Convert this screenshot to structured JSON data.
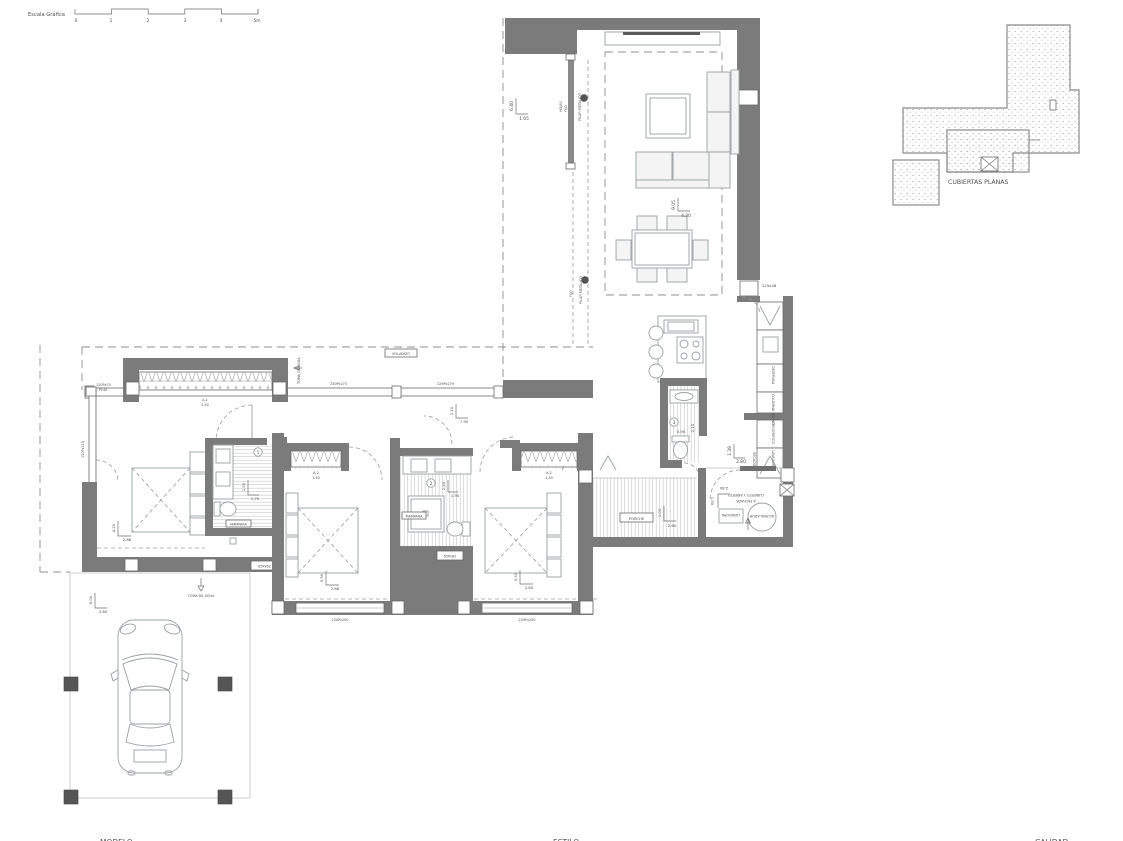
{
  "colors": {
    "background": "#ffffff",
    "wall": "#7b7b7b",
    "pillar_dark": "#555555",
    "line_light": "#9aa0a2",
    "hatch": "#cccccc",
    "dashed": "#8f8f8f",
    "text": "#4f4f4f",
    "stipple": "#a8a8a8"
  },
  "scale_bar": {
    "label": "Escala Gráfica",
    "ticks": [
      "0",
      "1",
      "2",
      "3",
      "4",
      "5m"
    ]
  },
  "roof_plan": {
    "label": "CUBIERTAS PLANAS"
  },
  "living_room": {
    "dim_v": "6.40",
    "dim_h": "1.65",
    "pilar1": "PILAR METÁLICO",
    "pilar2": "PILAR METÁLICO",
    "glass_l1": "HOJAS",
    "glass_l2": "FIJO",
    "glass2": "FIJO"
  },
  "dining": {
    "dim_v": "9.05",
    "dim_h": "4.30"
  },
  "front": {
    "voladizo": "VOLADIZO",
    "window1": "230Px275",
    "window2": "229Px279",
    "toma_agua": "TOMA DE AGUA",
    "hall_dim_v": "1.10",
    "hall_dim_h": "7.90"
  },
  "master_bedroom": {
    "window_code": "A-1",
    "window_size": "2.40",
    "side_l1": "120Px70",
    "side_l2": "PL40",
    "glass_label": "130Px115",
    "dim_v": "4.20",
    "dim_h": "2.88",
    "small_window": "65Px62"
  },
  "bathroom1": {
    "number": "1",
    "dim_v": "1.50",
    "dim_h": "1.70",
    "box_label": "MAMPARA"
  },
  "bedroom2": {
    "window_code": "A-2",
    "window_size": "1.40",
    "dim_v": "3.50",
    "dim_h": "2.88",
    "bottom_window": "230Px200"
  },
  "bathroom2": {
    "number": "2",
    "dim_v": "2.40",
    "dim_h": "1.90",
    "box_label": "MAMPARA",
    "small_window": "65Px62"
  },
  "bedroom3": {
    "window_code": "A-2",
    "window_size": "1.40",
    "dim_v": "3.50",
    "dim_h": "2.80",
    "bottom_window": "230Px200"
  },
  "wc3": {
    "number": "3",
    "dim_v": "2.15",
    "dim_h": "0.90"
  },
  "kitchen": {
    "entry_label": "125x48",
    "dim_v": "1.38",
    "dim_h": "2.80",
    "cabinets": [
      "DESPENSA",
      "COLUMNA HORNO",
      "FRIGORIFICO",
      "LAVADORA",
      "SECADORA"
    ]
  },
  "porch": {
    "label": "PORCHE",
    "dim_v": "1.00",
    "dim_h": "2.60"
  },
  "laundry": {
    "note_l1": "CUBIERTO Y ABIERTO",
    "note_l2": "A FACHADA",
    "tank_label": "ACUMULADOR",
    "box_label": "LAVADORA",
    "dim_v": "1.50",
    "dim_h": "2.80"
  },
  "carport": {
    "dim_v": "6.00",
    "dim_h": "3.80",
    "water_label": "TOMA DE AGUA"
  },
  "footer": {
    "left": "MODELO",
    "center": "ESTILO",
    "right": "CALIDAD"
  }
}
